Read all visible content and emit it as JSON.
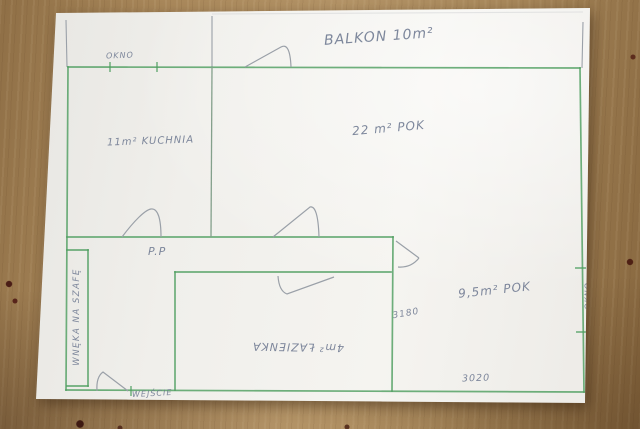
{
  "photo": {
    "description_labels": {
      "balcony": "BALKON 10m²",
      "window_top": "OKNO",
      "kitchen": "11m² KUCHNIA",
      "room_large": "22 m² POK",
      "hallway": "P.P",
      "wardrobe_niche": "WNĘKA NA SZAFĘ",
      "bathroom": "4m² ŁAZIENKA",
      "room_small": "9,5m² POK",
      "dimension_room_small_depth": "3180",
      "dimension_room_small_width": "3020",
      "window_right": "OKNO",
      "entrance": "WEJŚCIE"
    },
    "colors": {
      "wall_ink_green": "#4f9f60",
      "pencil_gray": "#9aa0a8",
      "handwriting_pencil": "#6d7890",
      "paper_white": "#f2f1ed",
      "table_wood_brown": "#a8875a"
    }
  }
}
